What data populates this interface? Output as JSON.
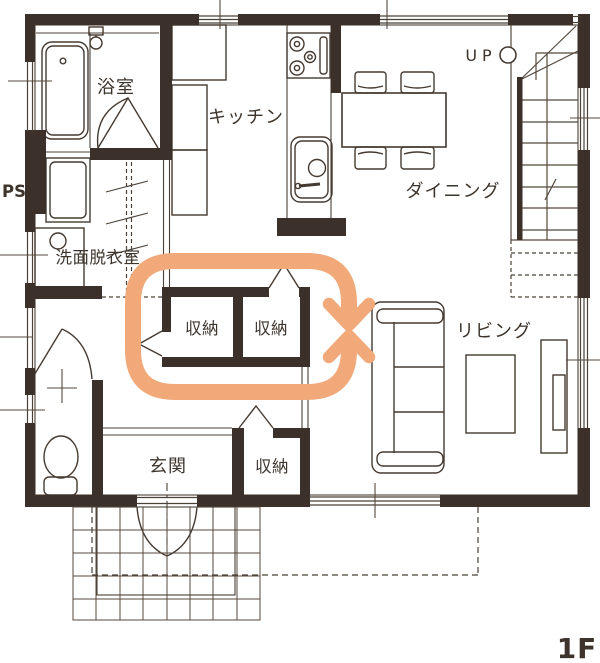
{
  "title": "1F floor plan",
  "floor": {
    "label": "1F"
  },
  "labels": {
    "bathroom": "浴室",
    "kitchen": "キッチン",
    "dining": "ダイニング",
    "living": "リビング",
    "washroom": "洗面脱衣室",
    "entrance": "玄関",
    "storage_left": "収納",
    "storage_right": "収納",
    "storage_entrance": "収納",
    "pipe_space": "PS",
    "stairs_up": "UP"
  },
  "colors": {
    "wall": "#3b312a",
    "line": "#4b4137",
    "accent_arrow": "#f1a97a",
    "background": "#ffffff"
  },
  "icons": {
    "circulation_loop": "two-way-circulation-arrow-loop"
  }
}
